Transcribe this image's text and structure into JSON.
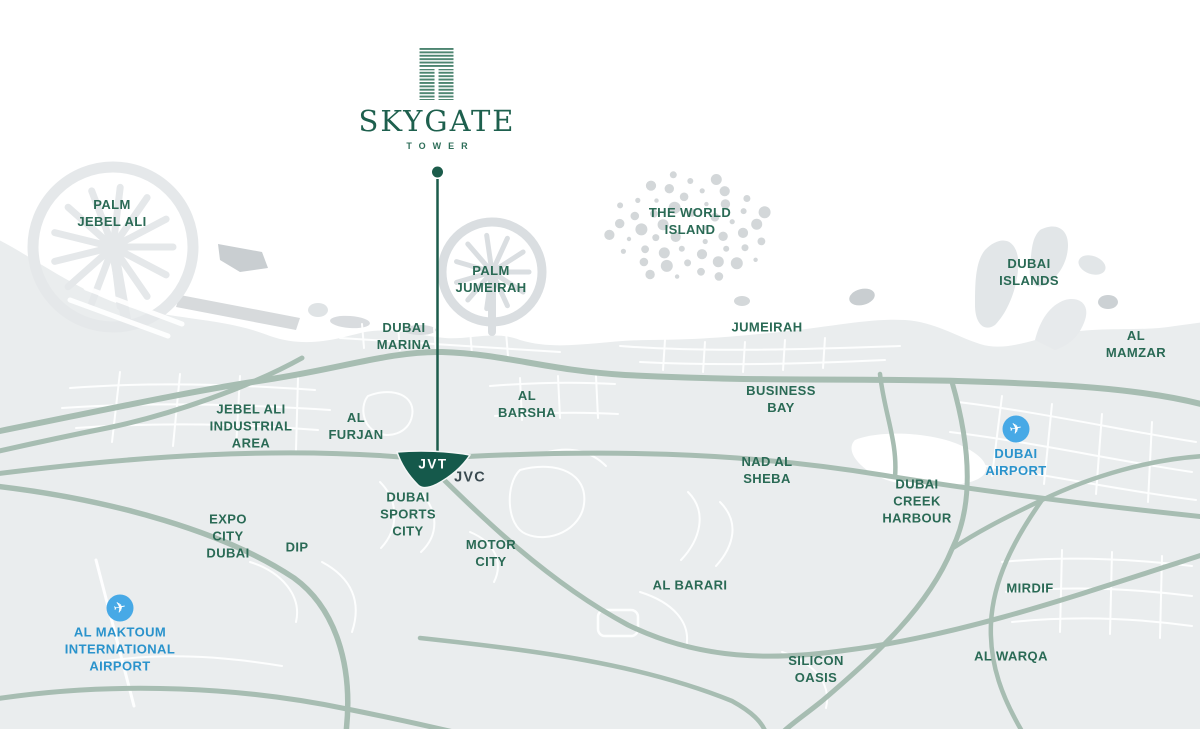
{
  "brand": {
    "title": "SKYGATE",
    "subtitle": "TOWER"
  },
  "map": {
    "jvt_label": "JVT",
    "airport_icon_glyph": "✈",
    "colors": {
      "brand_green": "#15594b",
      "label_green": "#2a6a55",
      "label_dark": "#3a4a50",
      "airport_blue": "#2a93cc",
      "airport_icon_blue": "#47a9e6",
      "road_sage": "#a7bdb2",
      "land_gray": "#eaedee",
      "island_gray": "#d3d7d9",
      "sea_white": "#ffffff"
    },
    "labels": [
      {
        "id": "palm-jebel-ali",
        "text": "PALM\nJEBEL ALI",
        "x": 112,
        "y": 213,
        "kind": "area"
      },
      {
        "id": "the-world-island",
        "text": "THE WORLD\nISLAND",
        "x": 690,
        "y": 221,
        "kind": "area"
      },
      {
        "id": "palm-jumeirah",
        "text": "PALM\nJUMEIRAH",
        "x": 491,
        "y": 279,
        "kind": "area"
      },
      {
        "id": "dubai-islands",
        "text": "DUBAI\nISLANDS",
        "x": 1029,
        "y": 272,
        "kind": "area"
      },
      {
        "id": "dubai-marina",
        "text": "DUBAI\nMARINA",
        "x": 404,
        "y": 336,
        "kind": "area"
      },
      {
        "id": "jumeirah",
        "text": "JUMEIRAH",
        "x": 767,
        "y": 327,
        "kind": "area"
      },
      {
        "id": "al-mamzar",
        "text": "AL\nMAMZAR",
        "x": 1136,
        "y": 344,
        "kind": "area"
      },
      {
        "id": "jebel-ali-industrial-area",
        "text": "JEBEL ALI\nINDUSTRIAL\nAREA",
        "x": 251,
        "y": 426,
        "kind": "area"
      },
      {
        "id": "al-furjan",
        "text": "AL\nFURJAN",
        "x": 356,
        "y": 426,
        "kind": "area"
      },
      {
        "id": "al-barsha",
        "text": "AL\nBARSHA",
        "x": 527,
        "y": 404,
        "kind": "area"
      },
      {
        "id": "business-bay",
        "text": "BUSINESS\nBAY",
        "x": 781,
        "y": 399,
        "kind": "area"
      },
      {
        "id": "nad-al-sheba",
        "text": "NAD AL\nSHEBA",
        "x": 767,
        "y": 470,
        "kind": "area"
      },
      {
        "id": "dubai-creek-harbour",
        "text": "DUBAI\nCREEK\nHARBOUR",
        "x": 917,
        "y": 501,
        "kind": "area"
      },
      {
        "id": "jvc",
        "text": "JVC",
        "x": 470,
        "y": 478,
        "kind": "dark"
      },
      {
        "id": "dubai-sports-city",
        "text": "DUBAI\nSPORTS\nCITY",
        "x": 408,
        "y": 514,
        "kind": "area"
      },
      {
        "id": "expo-city-dubai",
        "text": "EXPO\nCITY\nDUBAI",
        "x": 228,
        "y": 536,
        "kind": "area"
      },
      {
        "id": "dip",
        "text": "DIP",
        "x": 297,
        "y": 547,
        "kind": "area"
      },
      {
        "id": "motor-city",
        "text": "MOTOR\nCITY",
        "x": 491,
        "y": 553,
        "kind": "area"
      },
      {
        "id": "al-barari",
        "text": "AL BARARI",
        "x": 690,
        "y": 585,
        "kind": "area"
      },
      {
        "id": "mirdif",
        "text": "MIRDIF",
        "x": 1030,
        "y": 588,
        "kind": "area"
      },
      {
        "id": "al-warqa",
        "text": "AL WARQA",
        "x": 1011,
        "y": 656,
        "kind": "area"
      },
      {
        "id": "silicon-oasis",
        "text": "SILICON\nOASIS",
        "x": 816,
        "y": 669,
        "kind": "area"
      },
      {
        "id": "dubai-airport",
        "text": "DUBAI\nAIRPORT",
        "x": 1016,
        "y": 462,
        "kind": "airport",
        "icon": true,
        "icon_x": 1016,
        "icon_y": 429
      },
      {
        "id": "al-maktoum-international-airport",
        "text": "AL MAKTOUM\nINTERNATIONAL\nAIRPORT",
        "x": 120,
        "y": 649,
        "kind": "airport",
        "icon": true,
        "icon_x": 120,
        "icon_y": 608
      }
    ]
  }
}
